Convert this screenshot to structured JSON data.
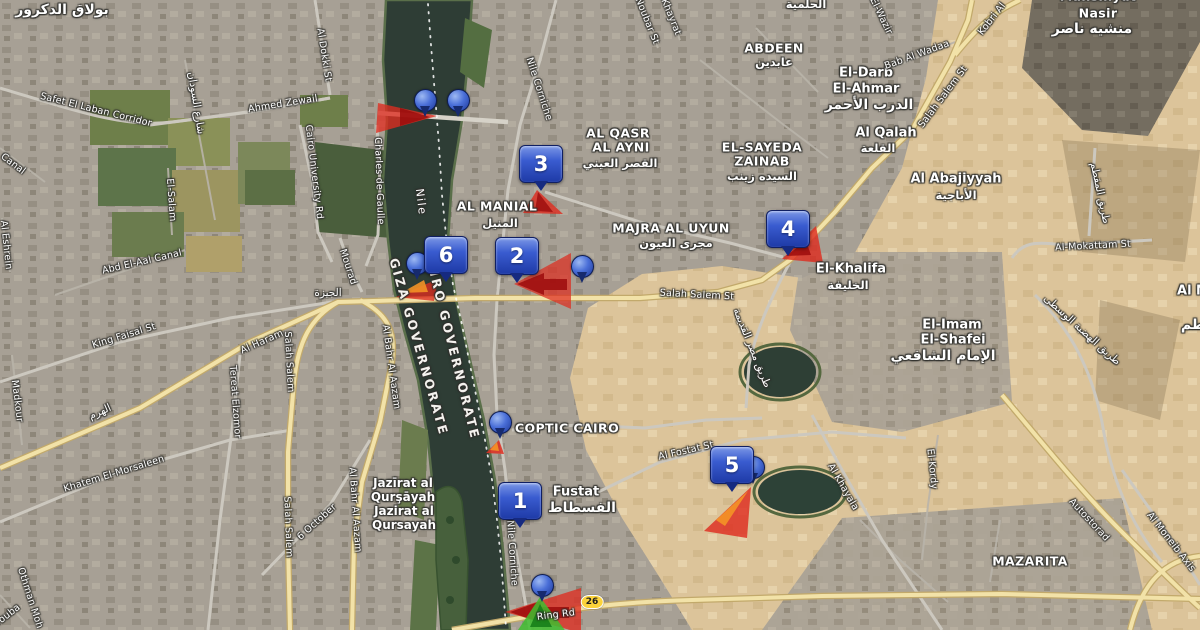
{
  "map": {
    "route_badge": {
      "text": "26",
      "x": 592,
      "y": 602
    },
    "colors": {
      "marker_blue": "#2e4cc0",
      "pin_blue": "#3a5fd0",
      "cone_red": "#de2d20",
      "cone_green": "#40be30",
      "road_yellow": "#f2e2a8",
      "river": "#2e3d35",
      "desert": "#dcc49a",
      "badge_yellow": "#fbd33b"
    },
    "markers": [
      {
        "label": "1",
        "x": 519,
        "y": 527
      },
      {
        "label": "2",
        "x": 516,
        "y": 282
      },
      {
        "label": "3",
        "x": 540,
        "y": 190
      },
      {
        "label": "4",
        "x": 787,
        "y": 255
      },
      {
        "label": "5",
        "x": 731,
        "y": 491
      },
      {
        "label": "6",
        "x": 445,
        "y": 281
      }
    ],
    "pins": [
      {
        "x": 424,
        "y": 118
      },
      {
        "x": 457,
        "y": 118
      },
      {
        "x": 416,
        "y": 281
      },
      {
        "x": 581,
        "y": 284
      },
      {
        "x": 499,
        "y": 440
      },
      {
        "x": 541,
        "y": 603
      },
      {
        "x": 752,
        "y": 485
      }
    ],
    "cones": [
      {
        "n": "view-cone-bridge-north",
        "p": "437,116 378,103 376,133",
        "f": "rgba(222,45,32,0.78)"
      },
      {
        "n": "view-cone-bridge-north-arrow",
        "p": "430,117 400,108 400,126",
        "f": "rgba(155,12,12,0.85)"
      },
      {
        "n": "view-cone-giza-bridge",
        "p": "438,279 396,297 434,301",
        "f": "rgba(222,45,32,0.78)"
      },
      {
        "n": "view-cone-giza-bridge-arrow",
        "p": "401,293 424,280 428,292",
        "f": "rgba(243,146,38,0.9)"
      },
      {
        "n": "view-cone-marker2",
        "p": "514,284 571,253 571,309",
        "f": "rgba(222,45,32,0.72)"
      },
      {
        "n": "view-cone-marker2-arrow",
        "p": "517,284 544,273 544,279 567,279 567,290 544,290 544,295",
        "f": "rgba(158,14,14,0.88)"
      },
      {
        "n": "view-cone-marker3",
        "p": "537,190 563,214 523,213",
        "f": "rgba(222,45,32,0.82)"
      },
      {
        "n": "view-cone-marker3-fold",
        "p": "538,192 553,212 535,211",
        "f": "rgba(158,14,14,0.85)"
      },
      {
        "n": "view-cone-marker4",
        "p": "782,259 816,226 823,263",
        "f": "rgba(222,45,32,0.82)"
      },
      {
        "n": "view-cone-marker4-arrow",
        "p": "786,256 806,241 811,255",
        "f": "rgba(158,14,14,0.88)"
      },
      {
        "n": "view-cone-marker5",
        "p": "751,487 704,531 747,538",
        "f": "rgba(222,45,32,0.82)"
      },
      {
        "n": "view-cone-marker5-arrow",
        "p": "748,491 716,520 725,526",
        "f": "rgba(243,146,38,0.92)"
      },
      {
        "n": "view-cone-coptic",
        "p": "499,440 486,453 504,454",
        "f": "rgba(222,45,32,0.85)"
      },
      {
        "n": "view-cone-coptic-arrow",
        "p": "497,442 490,450 499,451",
        "f": "rgba(243,146,38,0.92)"
      },
      {
        "n": "view-cone-ringroad-red",
        "p": "505,612 581,588 581,633",
        "f": "rgba(222,45,32,0.78)"
      },
      {
        "n": "view-cone-ringroad-red-arrow",
        "p": "510,612 541,601 541,607 569,607 569,618 541,618 541,623",
        "f": "rgba(158,14,14,0.88)"
      },
      {
        "n": "view-cone-ringroad-green",
        "p": "540,597 516,633 567,633",
        "f": "rgba(64,190,48,0.85)"
      },
      {
        "n": "view-cone-ringroad-green-arrow",
        "p": "540,604 530,627 552,627",
        "f": "rgba(22,128,26,0.9)"
      }
    ],
    "labels": [
      {
        "t": "بولاق الدكرور",
        "x": 62,
        "y": 10,
        "r": 0,
        "c": "big-ar",
        "n": "district-bulaq-dakrur"
      },
      {
        "t": "الحلمية",
        "x": 806,
        "y": 4,
        "r": 0,
        "c": "ar",
        "n": "district-helmeya"
      },
      {
        "t": "Manshiyat",
        "x": 1098,
        "y": -4,
        "r": 0,
        "c": "dist",
        "n": "district-manshiyat"
      },
      {
        "t": "Nasir",
        "x": 1098,
        "y": 13,
        "r": 0,
        "c": "dist",
        "n": "district-nasir"
      },
      {
        "t": "منشيه ناصر",
        "x": 1092,
        "y": 29,
        "r": 0,
        "c": "big-ar",
        "n": "district-nasir-ar"
      },
      {
        "t": "ABDEEN",
        "x": 774,
        "y": 48,
        "r": 0,
        "c": "dist",
        "n": "district-abdeen"
      },
      {
        "t": "عابدين",
        "x": 774,
        "y": 62,
        "r": 0,
        "c": "ar",
        "n": "district-abdeen-ar"
      },
      {
        "t": "AL QASR",
        "x": 618,
        "y": 133,
        "r": 0,
        "c": "dist",
        "n": "district-al-qasr"
      },
      {
        "t": "AL AYNI",
        "x": 621,
        "y": 147,
        "r": 0,
        "c": "dist",
        "n": "district-al-ayni"
      },
      {
        "t": "القصر العيني",
        "x": 620,
        "y": 163,
        "r": 0,
        "c": "ar",
        "n": "district-qasr-ayni-ar"
      },
      {
        "t": "EL-SAYEDA",
        "x": 762,
        "y": 147,
        "r": 0,
        "c": "dist",
        "n": "district-sayeda"
      },
      {
        "t": "ZAINAB",
        "x": 762,
        "y": 161,
        "r": 0,
        "c": "dist",
        "n": "district-zainab"
      },
      {
        "t": "السيده زينب",
        "x": 762,
        "y": 176,
        "r": 0,
        "c": "ar",
        "n": "district-sayeda-zainab-ar"
      },
      {
        "t": "El-Darb",
        "x": 866,
        "y": 73,
        "r": 0,
        "c": "place",
        "n": "district-el-darb"
      },
      {
        "t": "El-Ahmar",
        "x": 866,
        "y": 89,
        "r": 0,
        "c": "place",
        "n": "district-el-ahmar"
      },
      {
        "t": "الدرب الأحمر",
        "x": 869,
        "y": 105,
        "r": 0,
        "c": "big-ar",
        "n": "district-darb-ahmar-ar"
      },
      {
        "t": "Al Qalah",
        "x": 886,
        "y": 133,
        "r": 0,
        "c": "place",
        "n": "district-al-qalah"
      },
      {
        "t": "القلعة",
        "x": 878,
        "y": 148,
        "r": 0,
        "c": "ar",
        "n": "district-al-qalah-ar"
      },
      {
        "t": "Al Abajiyyah",
        "x": 956,
        "y": 179,
        "r": 0,
        "c": "place",
        "n": "district-al-abajiyyah"
      },
      {
        "t": "الأباجية",
        "x": 956,
        "y": 195,
        "r": 0,
        "c": "ar",
        "n": "district-al-abajiyyah-ar"
      },
      {
        "t": "AL MANIAL",
        "x": 497,
        "y": 206,
        "r": 0,
        "c": "dist",
        "n": "district-al-manial"
      },
      {
        "t": "المنيل",
        "x": 500,
        "y": 223,
        "r": 0,
        "c": "ar",
        "n": "district-al-manial-ar"
      },
      {
        "t": "MAJRA AL UYUN",
        "x": 671,
        "y": 228,
        "r": 0,
        "c": "dist",
        "n": "district-majra-al-uyun"
      },
      {
        "t": "مجرى العيون",
        "x": 676,
        "y": 243,
        "r": 0,
        "c": "ar",
        "n": "district-majra-al-uyun-ar"
      },
      {
        "t": "El-Khalifa",
        "x": 851,
        "y": 269,
        "r": 0,
        "c": "place",
        "n": "district-el-khalifa"
      },
      {
        "t": "الخليفة",
        "x": 848,
        "y": 285,
        "r": 0,
        "c": "ar",
        "n": "district-el-khalifa-ar"
      },
      {
        "t": "El-Imam",
        "x": 952,
        "y": 325,
        "r": 0,
        "c": "place",
        "n": "district-el-imam"
      },
      {
        "t": "El-Shafei",
        "x": 953,
        "y": 340,
        "r": 0,
        "c": "place",
        "n": "district-el-shafei"
      },
      {
        "t": "الإمام الشافعي",
        "x": 943,
        "y": 356,
        "r": 0,
        "c": "big-ar",
        "n": "district-imam-shafei-ar"
      },
      {
        "t": "Al M",
        "x": 1193,
        "y": 291,
        "r": 0,
        "c": "place",
        "n": "district-al-mokattam-cut"
      },
      {
        "t": "المقطم",
        "x": 1208,
        "y": 325,
        "r": 0,
        "c": "big-ar",
        "n": "district-al-mokattam-ar-cut"
      },
      {
        "t": "COPTIC CAIRO",
        "x": 567,
        "y": 428,
        "r": 0,
        "c": "dist",
        "n": "district-coptic-cairo"
      },
      {
        "t": "Fustat",
        "x": 576,
        "y": 492,
        "r": 0,
        "c": "place",
        "n": "district-fustat"
      },
      {
        "t": "الفسطاط",
        "x": 582,
        "y": 508,
        "r": 0,
        "c": "big-ar",
        "n": "district-fustat-ar"
      },
      {
        "t": "Jazīrat al",
        "x": 403,
        "y": 483,
        "r": 0,
        "c": "place2",
        "n": "island-jazirat-1"
      },
      {
        "t": "Qurşāyah",
        "x": 403,
        "y": 497,
        "r": 0,
        "c": "place2",
        "n": "island-jazirat-2"
      },
      {
        "t": "Jazirat al",
        "x": 404,
        "y": 511,
        "r": 0,
        "c": "place2",
        "n": "island-jazirat-3"
      },
      {
        "t": "Qursayah",
        "x": 404,
        "y": 525,
        "r": 0,
        "c": "place2",
        "n": "island-jazirat-4"
      },
      {
        "t": "MAZARITA",
        "x": 1030,
        "y": 561,
        "r": 0,
        "c": "dist",
        "n": "district-mazarita"
      },
      {
        "t": "GIZA GOVERNORATE",
        "x": 419,
        "y": 347,
        "r": 74,
        "c": "gov",
        "n": "giza-governorate-label"
      },
      {
        "t": "CAIRO GOVERNORATE",
        "x": 452,
        "y": 344,
        "r": 76,
        "c": "gov",
        "n": "cairo-governorate-label"
      },
      {
        "t": "Nile",
        "x": 421,
        "y": 202,
        "r": 83,
        "c": "street-lg",
        "n": "river-nile-label"
      },
      {
        "t": "Safet El Laban Corridor",
        "x": 96,
        "y": 110,
        "r": 14,
        "c": "street"
      },
      {
        "t": "Ahmed Zewail",
        "x": 283,
        "y": 104,
        "r": -9,
        "c": "street"
      },
      {
        "t": "Al Dokki St",
        "x": 324,
        "y": 55,
        "r": 81,
        "c": "street"
      },
      {
        "t": "شارع السودان",
        "x": 196,
        "y": 103,
        "r": 81,
        "c": "street-ar"
      },
      {
        "t": "Cairo University Rd",
        "x": 314,
        "y": 172,
        "r": 83,
        "c": "street"
      },
      {
        "t": "Charles de Gaulle",
        "x": 379,
        "y": 181,
        "r": 88,
        "c": "street"
      },
      {
        "t": "Mourad",
        "x": 348,
        "y": 267,
        "r": 72,
        "c": "street"
      },
      {
        "t": "El-Salam",
        "x": 171,
        "y": 200,
        "r": 86,
        "c": "street"
      },
      {
        "t": "Canal",
        "x": 13,
        "y": 164,
        "r": 37,
        "c": "street"
      },
      {
        "t": "Al Eshrein",
        "x": 6,
        "y": 245,
        "r": 84,
        "c": "street"
      },
      {
        "t": "Madkour",
        "x": 17,
        "y": 401,
        "r": 83,
        "c": "street"
      },
      {
        "t": "King Faisal St",
        "x": 124,
        "y": 336,
        "r": -17,
        "c": "street"
      },
      {
        "t": "Al Haram",
        "x": 262,
        "y": 342,
        "r": -24,
        "c": "street"
      },
      {
        "t": "الهرم",
        "x": 100,
        "y": 412,
        "r": -24,
        "c": "street-ar"
      },
      {
        "t": "Abd El-Aal Canal",
        "x": 142,
        "y": 262,
        "r": -13,
        "c": "street"
      },
      {
        "t": "Tereat Elzomor",
        "x": 235,
        "y": 402,
        "r": 86,
        "c": "street"
      },
      {
        "t": "Khatem El-Morsaleen",
        "x": 114,
        "y": 474,
        "r": -17,
        "c": "street"
      },
      {
        "t": "Salah Salem",
        "x": 289,
        "y": 362,
        "r": 87,
        "c": "street"
      },
      {
        "t": "Salah Salem",
        "x": 288,
        "y": 527,
        "r": 88,
        "c": "street"
      },
      {
        "t": "6 October",
        "x": 317,
        "y": 522,
        "r": -42,
        "c": "street"
      },
      {
        "t": "Al Bahr Al Aazam",
        "x": 391,
        "y": 367,
        "r": 82,
        "c": "street"
      },
      {
        "t": "Al Bahr Al Aazam",
        "x": 355,
        "y": 510,
        "r": 86,
        "c": "street"
      },
      {
        "t": "Nile Corniche",
        "x": 539,
        "y": 89,
        "r": 72,
        "c": "street"
      },
      {
        "t": "Nile Corniche",
        "x": 512,
        "y": 553,
        "r": 86,
        "c": "street"
      },
      {
        "t": "Noubar St",
        "x": 647,
        "y": 21,
        "r": 68,
        "c": "street"
      },
      {
        "t": "Khayrat",
        "x": 671,
        "y": 17,
        "r": 68,
        "c": "street"
      },
      {
        "t": "El-Wazir",
        "x": 881,
        "y": 16,
        "r": 64,
        "c": "street"
      },
      {
        "t": "Bab Al Wadaa",
        "x": 917,
        "y": 55,
        "r": -20,
        "c": "street"
      },
      {
        "t": "Kobri Al",
        "x": 992,
        "y": 19,
        "r": -52,
        "c": "street"
      },
      {
        "t": "Salah Salem St",
        "x": 943,
        "y": 97,
        "r": -53,
        "c": "street"
      },
      {
        "t": "Salah Salem St",
        "x": 697,
        "y": 295,
        "r": 3,
        "c": "street"
      },
      {
        "t": "الجيزة",
        "x": 328,
        "y": 293,
        "r": 0,
        "c": "street-ar"
      },
      {
        "t": "Al-Mokattam St",
        "x": 1093,
        "y": 246,
        "r": -3,
        "c": "street"
      },
      {
        "t": "طريق المقطم",
        "x": 1100,
        "y": 193,
        "r": 78,
        "c": "street-ar"
      },
      {
        "t": "طريق الهضبة الوسطى",
        "x": 1082,
        "y": 330,
        "r": 42,
        "c": "street-ar"
      },
      {
        "t": "طريق مصر القديمة",
        "x": 752,
        "y": 348,
        "r": 68,
        "c": "street-ar"
      },
      {
        "t": "Al Fostat St",
        "x": 686,
        "y": 451,
        "r": -13,
        "c": "street"
      },
      {
        "t": "Al Khayala",
        "x": 843,
        "y": 487,
        "r": 60,
        "c": "street"
      },
      {
        "t": "El-Kordy",
        "x": 932,
        "y": 469,
        "r": 84,
        "c": "street"
      },
      {
        "t": "Autostorad",
        "x": 1089,
        "y": 520,
        "r": 47,
        "c": "street"
      },
      {
        "t": "Al Moneib Axis",
        "x": 1171,
        "y": 542,
        "r": 52,
        "c": "street"
      },
      {
        "t": "Ring Rd",
        "x": 556,
        "y": 615,
        "r": -7,
        "c": "street"
      },
      {
        "t": "Othman Moh",
        "x": 30,
        "y": 598,
        "r": 72,
        "c": "street"
      },
      {
        "t": "rouba",
        "x": 8,
        "y": 615,
        "r": -38,
        "c": "street"
      }
    ]
  }
}
